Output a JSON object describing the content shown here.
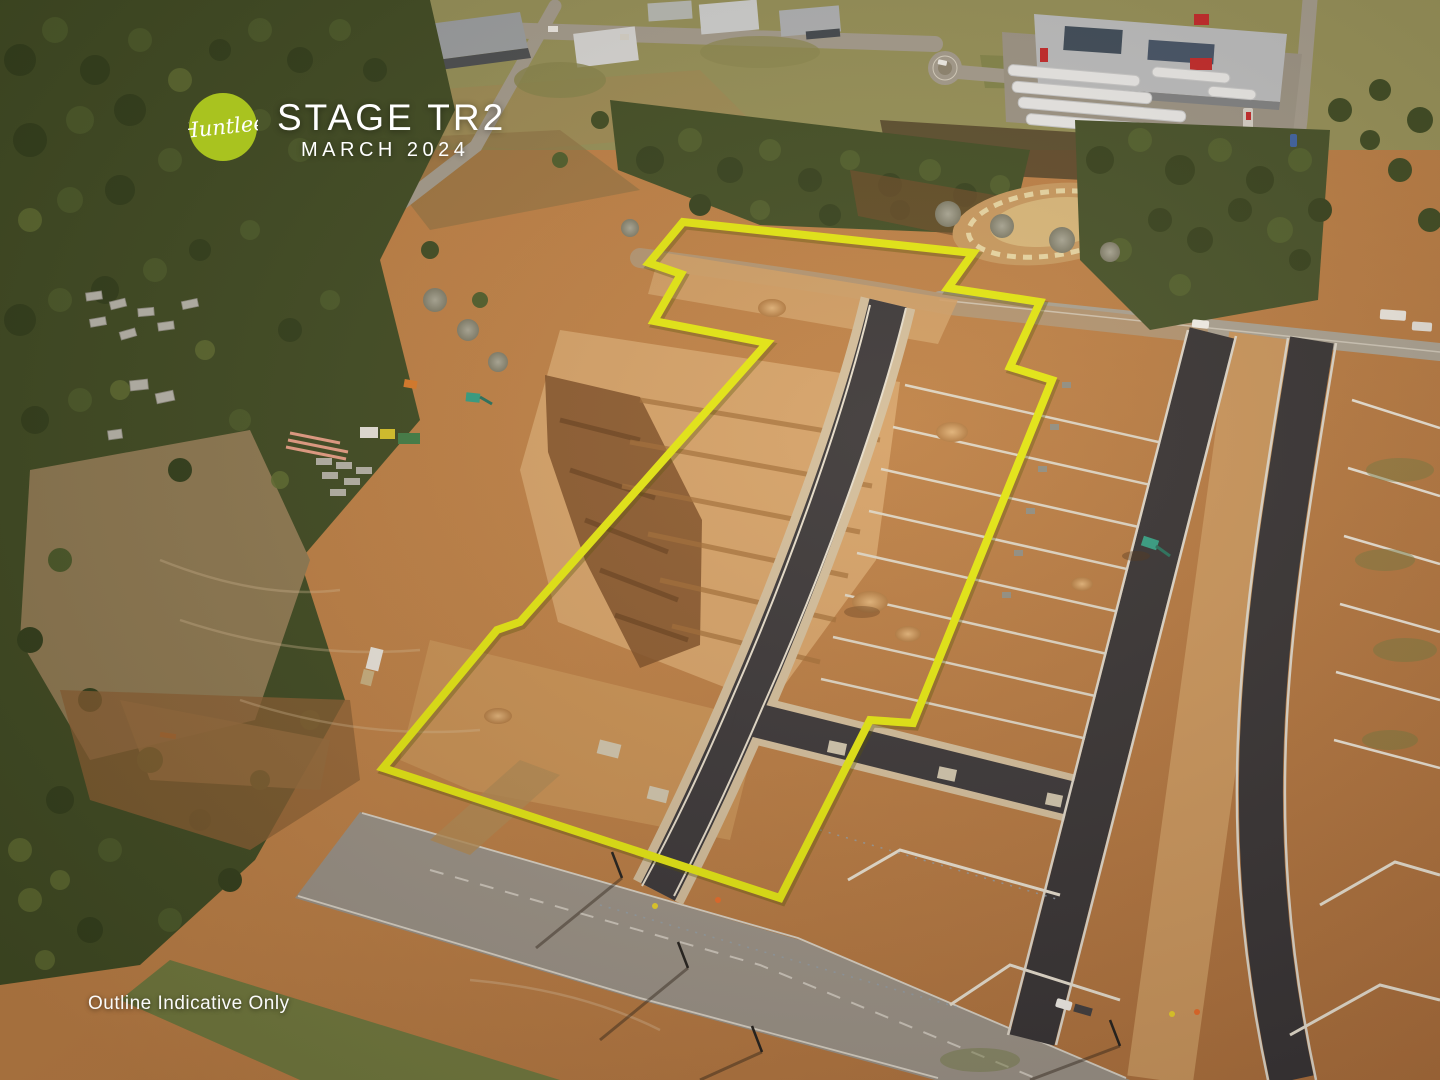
{
  "overlay": {
    "logo": {
      "text": "Huntlee",
      "circle_color": "#a9c31f",
      "text_color": "#ffffff"
    },
    "title": "STAGE TR2",
    "subtitle": "MARCH 2024",
    "disclaimer": "Outline Indicative Only",
    "outline": {
      "color": "#e4ea12",
      "shadow_color": "rgba(80,80,0,0.35)",
      "points": "683,222 973,253 948,288 1040,302 1010,367 1052,380 913,723 870,720 780,898 383,768 497,630 520,622 767,343 654,321 681,274 649,263"
    }
  },
  "scene": {
    "subject": "aerial-construction-subdivision-photo"
  }
}
